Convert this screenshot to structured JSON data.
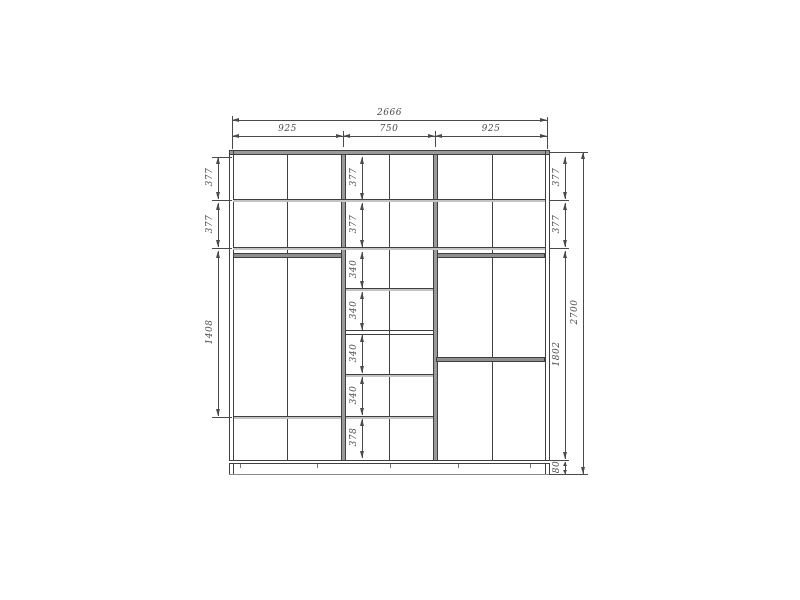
{
  "drawing": {
    "total_width": "2666",
    "total_height": "2700",
    "section_widths": [
      "925",
      "750",
      "925"
    ],
    "left_chain": [
      "377",
      "377",
      "1408"
    ],
    "middle_chain": [
      "377",
      "377",
      "340",
      "340",
      "340",
      "340",
      "378"
    ],
    "right_chain": [
      "377",
      "377",
      "1802",
      "80"
    ],
    "colors": {
      "background": "#ffffff",
      "structure_line": "#3f3f3f",
      "dimension_line": "#4a4a4a",
      "panel_gray": "#9a9a9a",
      "rod_gray": "#8f8f8f"
    }
  }
}
